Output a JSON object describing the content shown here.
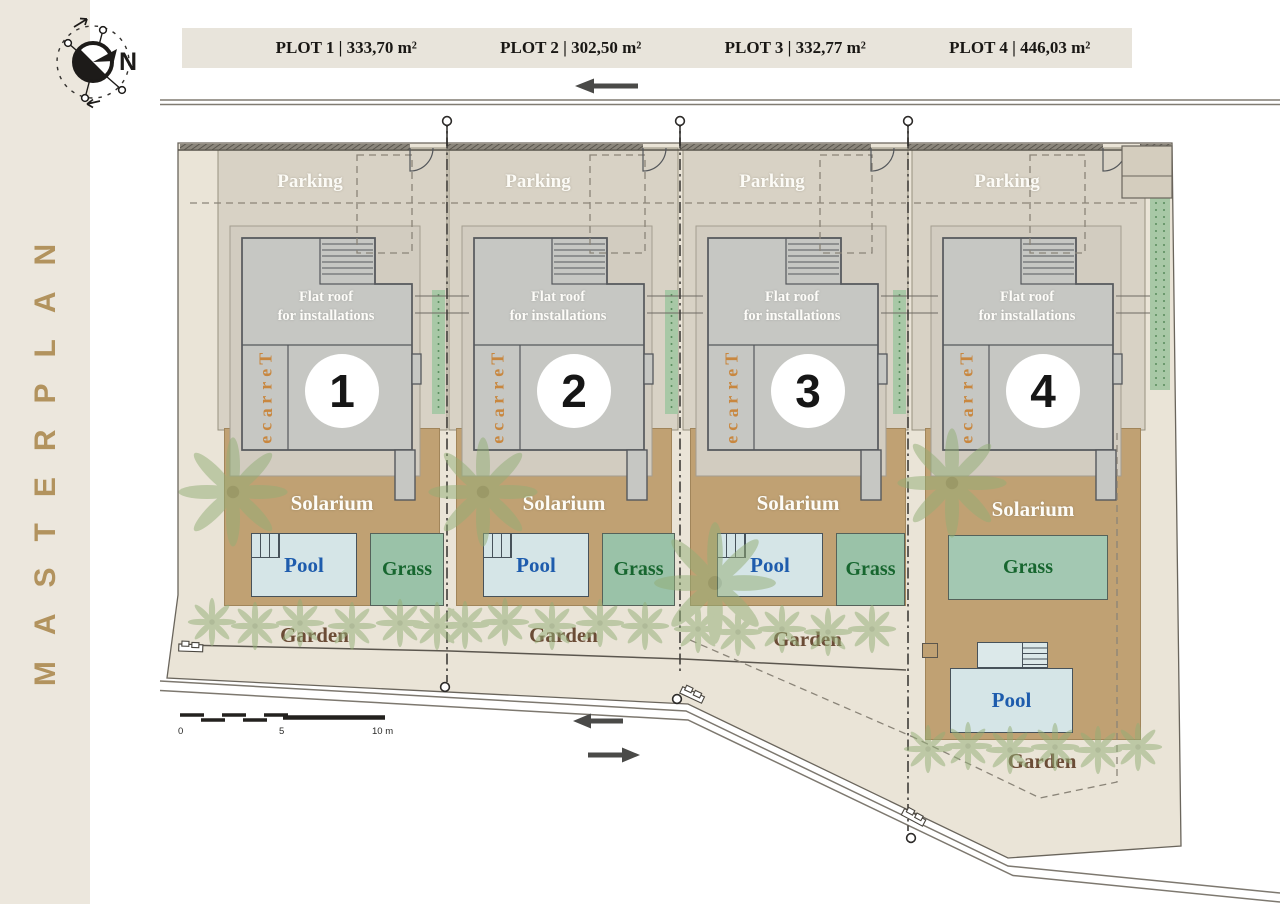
{
  "sidebar": {
    "title": "MASTERPLAN"
  },
  "compass": {
    "north": "N"
  },
  "header": {
    "plots": [
      {
        "label": "PLOT 1 | 333,70 m²"
      },
      {
        "label": "PLOT 2 | 302,50 m²"
      },
      {
        "label": "PLOT 3 | 332,77 m²"
      },
      {
        "label": "PLOT 4 | 446,03 m²"
      }
    ]
  },
  "plots": [
    {
      "number": "1",
      "parking_label": "Parking",
      "flat_roof_line1": "Flat roof",
      "flat_roof_line2": "for installations",
      "terrace_label": "Terrace",
      "solarium_label": "Solarium",
      "pool_label": "Pool",
      "grass_label": "Grass",
      "garden_label": "Garden"
    },
    {
      "number": "2",
      "parking_label": "Parking",
      "flat_roof_line1": "Flat roof",
      "flat_roof_line2": "for installations",
      "terrace_label": "Terrace",
      "solarium_label": "Solarium",
      "pool_label": "Pool",
      "grass_label": "Grass",
      "garden_label": "Garden"
    },
    {
      "number": "3",
      "parking_label": "Parking",
      "flat_roof_line1": "Flat roof",
      "flat_roof_line2": "for installations",
      "terrace_label": "Terrace",
      "solarium_label": "Solarium",
      "pool_label": "Pool",
      "grass_label": "Grass",
      "garden_label": "Garden"
    },
    {
      "number": "4",
      "parking_label": "Parking",
      "flat_roof_line1": "Flat roof",
      "flat_roof_line2": "for installations",
      "terrace_label": "Terrace",
      "solarium_label": "Solarium",
      "pool_label": "Pool",
      "grass_label": "Grass",
      "garden_label": "Garden"
    }
  ],
  "scale_bar": {
    "tick_0": "0",
    "tick_5": "5",
    "tick_10": "10 m"
  },
  "colors": {
    "accent_gold": "#b2935e",
    "site_ground": "#eae4d7",
    "parking_fill": "#d8d2c5",
    "building_gray": "#c6c7c3",
    "solarium_tan": "#c0a173",
    "pool_fill": "#d5e5e7",
    "pool_text": "#1e5cad",
    "grass_fill": "#9ac2a8",
    "grass_text": "#17662f",
    "garden_text": "#6b4c36",
    "terrace_text": "#c8873f",
    "hedge_green": "#a8c8a6"
  }
}
